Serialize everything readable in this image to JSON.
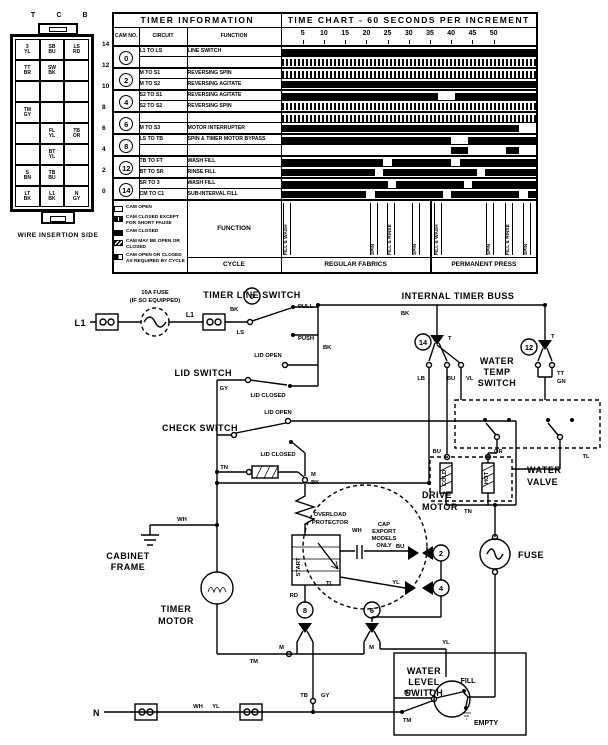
{
  "connector": {
    "caption": "WIRE INSERTION SIDE",
    "col_labels": [
      "T",
      "C",
      "B"
    ],
    "rows": [
      {
        "num": "14",
        "cells": [
          "3|YL",
          "SB|BU",
          "LS|RD"
        ]
      },
      {
        "num": "12",
        "cells": [
          "TT|BR",
          "SW|BK",
          ""
        ]
      },
      {
        "num": "10",
        "cells": [
          "",
          "",
          ""
        ]
      },
      {
        "num": "8",
        "cells": [
          "TM|GY",
          "",
          ""
        ]
      },
      {
        "num": "6",
        "cells": [
          "",
          "FL|YL",
          "TB|OR"
        ]
      },
      {
        "num": "4",
        "cells": [
          "",
          "BT|YL",
          ""
        ]
      },
      {
        "num": "2",
        "cells": [
          "S|BN",
          "TB|BU",
          ""
        ]
      },
      {
        "num": "0",
        "cells": [
          "LT|BK",
          "L1|BK",
          "N|GY"
        ]
      }
    ]
  },
  "timer_table": {
    "title": "TIMER INFORMATION",
    "chart_title": "TIME CHART - 60 SECONDS PER INCREMENT",
    "col_cam": "CAM NO.",
    "col_circuit": "CIRCUIT",
    "col_function": "FUNCTION",
    "function_label": "FUNCTION",
    "cycle_label": "CYCLE",
    "ticks": [
      5,
      10,
      15,
      20,
      25,
      30,
      35,
      40,
      45,
      50
    ],
    "increments": 60,
    "legend": [
      {
        "swatch": "open",
        "label": "CAM OPEN"
      },
      {
        "swatch": "slit",
        "label": "CAM CLOSED EXCEPT FOR SHORT PAUSE"
      },
      {
        "swatch": "closed",
        "label": "CAM CLOSED"
      },
      {
        "swatch": "mixed",
        "label": "CAM MAY BE OPEN OR CLOSED"
      },
      {
        "swatch": "half",
        "label": "CAM OPEN OR CLOSED AS REQUIRED BY CYCLE"
      }
    ],
    "cycles": [
      {
        "name": "REGULAR FABRICS",
        "width_pct": 59,
        "phases": [
          {
            "label": "FILL & WASH",
            "pos_pct": 1
          },
          {
            "label": "SPIN",
            "pos_pct": 60
          },
          {
            "label": "FILL & RINSE",
            "pos_pct": 71
          },
          {
            "label": "SPIN",
            "pos_pct": 88
          }
        ]
      },
      {
        "name": "PERMANENT PRESS",
        "width_pct": 41,
        "phases": [
          {
            "label": "FILL & WASH",
            "pos_pct": 2
          },
          {
            "label": "SPIN",
            "pos_pct": 52
          },
          {
            "label": "FILL & RINSE",
            "pos_pct": 70
          },
          {
            "label": "SPIN",
            "pos_pct": 88
          }
        ]
      }
    ],
    "rows": [
      {
        "cam": "0",
        "circuits": [
          {
            "circuit": "L1 TO LS",
            "function": "LINE SWITCH",
            "bar": [
              [
                "solid",
                0,
                60
              ]
            ]
          },
          {
            "circuit": "",
            "function": "",
            "bar": [
              [
                "hatch",
                0,
                60
              ]
            ]
          }
        ]
      },
      {
        "cam": "2",
        "circuits": [
          {
            "circuit": "M TO S1",
            "function": "REVERSING SPIN",
            "bar": [
              [
                "hatch",
                0,
                60
              ]
            ]
          },
          {
            "circuit": "M TO S2",
            "function": "REVERSING AGITATE",
            "bar": [
              [
                "solid",
                0,
                60
              ]
            ]
          }
        ]
      },
      {
        "cam": "4",
        "circuits": [
          {
            "circuit": "S2 TO S1",
            "function": "REVERSING AGITATE",
            "bar": [
              [
                "solid",
                0,
                37
              ],
              [
                "solid",
                41,
                60
              ]
            ]
          },
          {
            "circuit": "S2 TO S2",
            "function": "REVERSING SPIN",
            "bar": [
              [
                "hatch",
                0,
                60
              ]
            ]
          }
        ]
      },
      {
        "cam": "6",
        "circuits": [
          {
            "circuit": "",
            "function": "",
            "bar": [
              [
                "hatch",
                0,
                60
              ]
            ]
          },
          {
            "circuit": "M TO S3",
            "function": "MOTOR INTERRUPTER",
            "bar": [
              [
                "solid",
                0,
                56
              ]
            ]
          }
        ]
      },
      {
        "cam": "8",
        "circuits": [
          {
            "circuit": "LS TO TB",
            "function": "SPIN & TIMER MOTOR BYPASS",
            "bar": [
              [
                "solid",
                0,
                40
              ],
              [
                "solid",
                44,
                60
              ]
            ]
          },
          {
            "circuit": "",
            "function": "",
            "bar": [
              [
                "solid",
                40,
                44
              ],
              [
                "solid",
                53,
                56
              ]
            ]
          }
        ]
      },
      {
        "cam": "12",
        "circuits": [
          {
            "circuit": "TB TO FT",
            "function": "WASH FILL",
            "bar": [
              [
                "solid",
                0,
                24
              ],
              [
                "solid",
                26,
                40
              ],
              [
                "solid",
                42,
                60
              ]
            ]
          },
          {
            "circuit": "BT TO SR",
            "function": "RINSE FILL",
            "bar": [
              [
                "solid",
                0,
                22
              ],
              [
                "solid",
                24,
                46
              ],
              [
                "solid",
                48,
                60
              ]
            ]
          }
        ]
      },
      {
        "cam": "14",
        "circuits": [
          {
            "circuit": "SR TO 3",
            "function": "WASH FILL",
            "bar": [
              [
                "solid",
                0,
                25
              ],
              [
                "solid",
                27,
                43
              ],
              [
                "solid",
                45,
                60
              ]
            ]
          },
          {
            "circuit": "CM TO C1",
            "function": "SUB-INTERVAL FILL",
            "bar": [
              [
                "solid",
                0,
                20
              ],
              [
                "solid",
                22,
                38
              ],
              [
                "solid",
                40,
                56
              ],
              [
                "solid",
                58,
                60
              ]
            ]
          }
        ]
      }
    ]
  },
  "schematic": {
    "cams": [
      {
        "n": "0",
        "x": 252,
        "y": 11
      },
      {
        "n": "14",
        "x": 423,
        "y": 57
      },
      {
        "n": "12",
        "x": 529,
        "y": 62
      },
      {
        "n": "2",
        "x": 441,
        "y": 268
      },
      {
        "n": "4",
        "x": 441,
        "y": 303
      },
      {
        "n": "8",
        "x": 305,
        "y": 325
      },
      {
        "n": "6",
        "x": 372,
        "y": 325
      }
    ],
    "labels": [
      {
        "t": "TIMER LINE SWITCH",
        "x": 252,
        "y": 13,
        "s": "b",
        "a": "middle"
      },
      {
        "t": "10A FUSE",
        "x": 155,
        "y": 9,
        "s": "t",
        "a": "middle"
      },
      {
        "t": "(IF SO EQUIPPED)",
        "x": 155,
        "y": 17,
        "s": "t",
        "a": "middle"
      },
      {
        "t": "L1",
        "x": 86,
        "y": 41,
        "s": "b",
        "a": "end"
      },
      {
        "t": "L1",
        "x": 190,
        "y": 32,
        "s": "n",
        "a": "middle"
      },
      {
        "t": "BK",
        "x": 230,
        "y": 26,
        "s": "t",
        "a": "start"
      },
      {
        "t": "LS",
        "x": 244,
        "y": 49,
        "s": "t",
        "a": "end"
      },
      {
        "t": "PULL",
        "x": 298,
        "y": 23,
        "s": "t",
        "a": "start"
      },
      {
        "t": "PUSH",
        "x": 298,
        "y": 55,
        "s": "t",
        "a": "start"
      },
      {
        "t": "INTERNAL TIMER BUSS",
        "x": 458,
        "y": 14,
        "s": "b",
        "a": "middle"
      },
      {
        "t": "BK",
        "x": 405,
        "y": 30,
        "s": "t",
        "a": "middle"
      },
      {
        "t": "BK",
        "x": 323,
        "y": 64,
        "s": "t",
        "a": "start"
      },
      {
        "t": "LID SWITCH",
        "x": 232,
        "y": 91,
        "s": "b",
        "a": "end"
      },
      {
        "t": "LID OPEN",
        "x": 268,
        "y": 72,
        "s": "t",
        "a": "middle"
      },
      {
        "t": "LID CLOSED",
        "x": 268,
        "y": 112,
        "s": "t",
        "a": "middle"
      },
      {
        "t": "GY",
        "x": 228,
        "y": 105,
        "s": "t",
        "a": "end"
      },
      {
        "t": "CHECK SWITCH",
        "x": 238,
        "y": 146,
        "s": "b",
        "a": "end"
      },
      {
        "t": "LID OPEN",
        "x": 278,
        "y": 129,
        "s": "t",
        "a": "middle"
      },
      {
        "t": "LID CLOSED",
        "x": 278,
        "y": 171,
        "s": "t",
        "a": "middle"
      },
      {
        "t": "TN",
        "x": 228,
        "y": 184,
        "s": "t",
        "a": "end"
      },
      {
        "t": "M",
        "x": 311,
        "y": 191,
        "s": "t",
        "a": "start"
      },
      {
        "t": "BK",
        "x": 311,
        "y": 199,
        "s": "t",
        "a": "start"
      },
      {
        "t": "WH",
        "x": 182,
        "y": 236,
        "s": "t",
        "a": "middle"
      },
      {
        "t": "CABINET",
        "x": 128,
        "y": 274,
        "s": "b",
        "a": "middle"
      },
      {
        "t": "FRAME",
        "x": 128,
        "y": 285,
        "s": "b",
        "a": "middle"
      },
      {
        "t": "DRIVE",
        "x": 422,
        "y": 213,
        "s": "b",
        "a": "start"
      },
      {
        "t": "MOTOR",
        "x": 422,
        "y": 225,
        "s": "b",
        "a": "start"
      },
      {
        "t": "OVERLOAD",
        "x": 330,
        "y": 231,
        "s": "t",
        "a": "middle"
      },
      {
        "t": "PROTECTOR",
        "x": 330,
        "y": 239,
        "s": "t",
        "a": "middle"
      },
      {
        "t": "CAP",
        "x": 384,
        "y": 241,
        "s": "t",
        "a": "middle"
      },
      {
        "t": "EXPORT",
        "x": 384,
        "y": 248,
        "s": "t",
        "a": "middle"
      },
      {
        "t": "MODELS",
        "x": 384,
        "y": 255,
        "s": "t",
        "a": "middle"
      },
      {
        "t": "ONLY",
        "x": 384,
        "y": 262,
        "s": "t",
        "a": "middle"
      },
      {
        "t": "WH",
        "x": 352,
        "y": 247,
        "s": "t",
        "a": "start"
      },
      {
        "t": "BU",
        "x": 400,
        "y": 263,
        "s": "t",
        "a": "middle"
      },
      {
        "t": "YL",
        "x": 396,
        "y": 299,
        "s": "t",
        "a": "middle"
      },
      {
        "t": "RD",
        "x": 298,
        "y": 312,
        "s": "t",
        "a": "end"
      },
      {
        "t": "TL",
        "x": 326,
        "y": 300,
        "s": "t",
        "a": "start"
      },
      {
        "t": "START",
        "x": 300,
        "y": 282,
        "s": "v",
        "a": "middle"
      },
      {
        "t": "TIMER",
        "x": 176,
        "y": 327,
        "s": "b",
        "a": "middle"
      },
      {
        "t": "MOTOR",
        "x": 176,
        "y": 339,
        "s": "b",
        "a": "middle"
      },
      {
        "t": "TM",
        "x": 258,
        "y": 378,
        "s": "t",
        "a": "end"
      },
      {
        "t": "M",
        "x": 284,
        "y": 364,
        "s": "t",
        "a": "end"
      },
      {
        "t": "M",
        "x": 374,
        "y": 364,
        "s": "t",
        "a": "end"
      },
      {
        "t": "TB",
        "x": 308,
        "y": 412,
        "s": "t",
        "a": "end"
      },
      {
        "t": "GY",
        "x": 321,
        "y": 412,
        "s": "t",
        "a": "start"
      },
      {
        "t": "WATER",
        "x": 497,
        "y": 79,
        "s": "b",
        "a": "middle"
      },
      {
        "t": "TEMP",
        "x": 497,
        "y": 90,
        "s": "b",
        "a": "middle"
      },
      {
        "t": "SWITCH",
        "x": 497,
        "y": 101,
        "s": "b",
        "a": "middle"
      },
      {
        "t": "T",
        "x": 448,
        "y": 55,
        "s": "t",
        "a": "start"
      },
      {
        "t": "T",
        "x": 551,
        "y": 53,
        "s": "t",
        "a": "start"
      },
      {
        "t": "LB",
        "x": 425,
        "y": 95,
        "s": "t",
        "a": "end"
      },
      {
        "t": "BU",
        "x": 451,
        "y": 95,
        "s": "t",
        "a": "middle"
      },
      {
        "t": "VL",
        "x": 466,
        "y": 95,
        "s": "t",
        "a": "start"
      },
      {
        "t": "TT",
        "x": 557,
        "y": 90,
        "s": "t",
        "a": "start"
      },
      {
        "t": "GN",
        "x": 557,
        "y": 98,
        "s": "t",
        "a": "start"
      },
      {
        "t": "TL",
        "x": 586,
        "y": 173,
        "s": "t",
        "a": "middle"
      },
      {
        "t": "WATER",
        "x": 527,
        "y": 188,
        "s": "b",
        "a": "start"
      },
      {
        "t": "VALVE",
        "x": 527,
        "y": 200,
        "s": "b",
        "a": "start"
      },
      {
        "t": "COLD",
        "x": 446,
        "y": 193,
        "s": "vt",
        "a": "middle"
      },
      {
        "t": "HOT",
        "x": 488,
        "y": 193,
        "s": "vt",
        "a": "middle"
      },
      {
        "t": "BU",
        "x": 441,
        "y": 168,
        "s": "t",
        "a": "end"
      },
      {
        "t": "OR",
        "x": 494,
        "y": 168,
        "s": "t",
        "a": "start"
      },
      {
        "t": "TN",
        "x": 468,
        "y": 228,
        "s": "t",
        "a": "middle"
      },
      {
        "t": "FUSE",
        "x": 518,
        "y": 273,
        "s": "b",
        "a": "start"
      },
      {
        "t": "WATER",
        "x": 424,
        "y": 389,
        "s": "b",
        "a": "middle"
      },
      {
        "t": "LEVEL",
        "x": 424,
        "y": 400,
        "s": "b",
        "a": "middle"
      },
      {
        "t": "SWITCH",
        "x": 424,
        "y": 411,
        "s": "b",
        "a": "middle"
      },
      {
        "t": "FILL",
        "x": 468,
        "y": 398,
        "s": "n",
        "a": "middle"
      },
      {
        "t": "EMPTY",
        "x": 474,
        "y": 440,
        "s": "n",
        "a": "start"
      },
      {
        "t": "T",
        "x": 432,
        "y": 408,
        "s": "t",
        "a": "end"
      },
      {
        "t": "BT",
        "x": 408,
        "y": 409,
        "s": "t",
        "a": "middle"
      },
      {
        "t": "TM",
        "x": 407,
        "y": 437,
        "s": "t",
        "a": "middle"
      },
      {
        "t": "YL",
        "x": 446,
        "y": 359,
        "s": "t",
        "a": "middle"
      },
      {
        "t": "N",
        "x": 100,
        "y": 431,
        "s": "b",
        "a": "end"
      },
      {
        "t": "WH",
        "x": 198,
        "y": 423,
        "s": "t",
        "a": "middle"
      },
      {
        "t": "YL",
        "x": 216,
        "y": 423,
        "s": "t",
        "a": "middle"
      }
    ]
  }
}
